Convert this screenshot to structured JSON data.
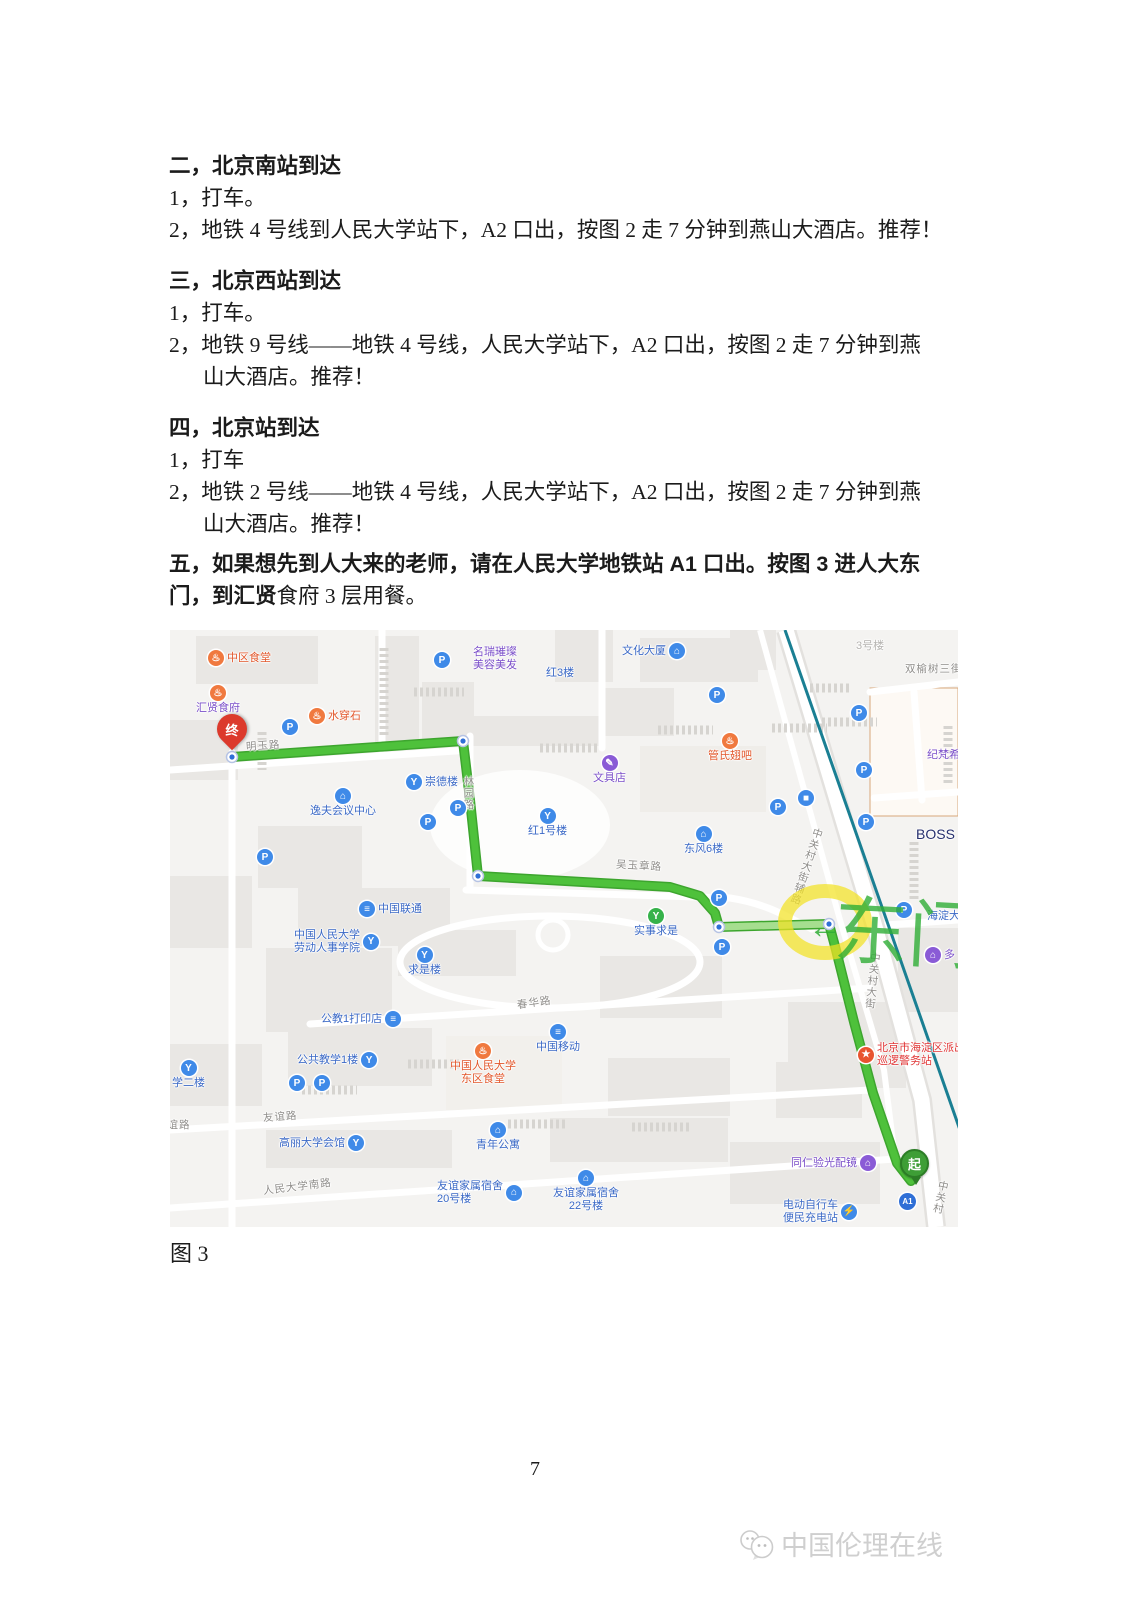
{
  "document": {
    "lines": [
      {
        "style": "h",
        "text": "二，北京南站到达"
      },
      {
        "style": "b",
        "text": "1，打车。"
      },
      {
        "style": "b",
        "text": "2，地铁 4 号线到人民大学站下，A2 口出，按图 2 走 7 分钟到燕山大酒店。推荐！"
      },
      {
        "style": "h",
        "text": "三，北京西站到达"
      },
      {
        "style": "b",
        "text": "1，打车。"
      },
      {
        "style": "b",
        "text": "2，地铁 9 号线——地铁 4 号线，人民大学站下，A2 口出，按图 2 走 7 分钟到燕"
      },
      {
        "style": "bi",
        "text": "山大酒店。推荐！"
      },
      {
        "style": "h",
        "text": "四，北京站到达"
      },
      {
        "style": "b",
        "text": "1，打车"
      },
      {
        "style": "b",
        "text": "2，地铁 2 号线——地铁 4 号线，人民大学站下，A2 口出，按图 2 走 7 分钟到燕"
      },
      {
        "style": "bi",
        "text": "山大酒店。推荐！"
      },
      {
        "style": "bold",
        "text": "五，如果想先到人大来的老师，请在人民大学地铁站 A1 口出。按图 3 进人大东"
      },
      {
        "style": "mixed",
        "bold": "门，到汇贤",
        "regular": "食府 3 层用餐。"
      }
    ]
  },
  "figure_caption": "图 3",
  "page_number": "7",
  "watermark": {
    "text": "中国伦理在线"
  },
  "map": {
    "palette": {
      "blue": "#3b69c6",
      "orange": "#e2572b",
      "purple": "#7b4fc9",
      "gray": "#8f8d8a",
      "red": "#e03636",
      "navy": "#27306e",
      "faded": "#b5b3b0"
    },
    "icon_defs": {
      "parking": {
        "g": "P",
        "bg": "#3f8ae8"
      },
      "food": {
        "g": "♨",
        "bg": "#f0793f"
      },
      "building": {
        "g": "⌂",
        "bg": "#3f8ae8"
      },
      "scenic": {
        "g": "Y",
        "bg": "#3f8ae8"
      },
      "telecom": {
        "g": "≡",
        "bg": "#3f8ae8"
      },
      "mobile": {
        "g": "≡",
        "bg": "#3f8ae8"
      },
      "bus": {
        "g": "■",
        "bg": "#3f8ae8"
      },
      "monument": {
        "g": "Y",
        "bg": "#36b24a"
      },
      "police": {
        "g": "★",
        "bg": "#e8542f"
      },
      "shop": {
        "g": "✎",
        "bg": "#8a5bd6"
      },
      "bag": {
        "g": "⌂",
        "bg": "#8a5bd6"
      },
      "charge": {
        "g": "⚡",
        "bg": "#3f8ae8"
      }
    },
    "route": {
      "points": "62,127 293,111 300,170 308,246 500,257 530,266 545,283 549,297 659,294 666,320 684,392 703,463 727,533 741,551",
      "light_points": "549,297 659,294",
      "color": "#4ec13b",
      "casing": "#3da52e",
      "light": "#a6de8f",
      "nodes": [
        [
          62,
          127
        ],
        [
          293,
          111
        ],
        [
          308,
          246
        ],
        [
          549,
          297
        ],
        [
          659,
          294
        ]
      ]
    },
    "subway": {
      "x1": 615,
      "y1": 0,
      "x2": 790,
      "y2": 500,
      "color": "#1a7f93"
    },
    "highlight": {
      "cx": 655,
      "cy": 292,
      "rx": 40,
      "ry": 31,
      "color": "#f3e224"
    },
    "annotation": {
      "text": "东门",
      "arrow": "←",
      "color": "#2fae36"
    },
    "markers": {
      "end_label": "终",
      "start_label": "起",
      "exit_label": "A1"
    },
    "pois": [
      {
        "name": "poi-zhongqu-canteen",
        "x": 38,
        "y": 20,
        "icon": "food",
        "pos": "left",
        "label": "中区食堂",
        "color": "orange"
      },
      {
        "name": "poi-mingrui-salon",
        "x": 303,
        "y": 16,
        "label": "名瑞璀璨\n美容美发",
        "color": "purple"
      },
      {
        "name": "poi-wenhua-plaza",
        "x": 452,
        "y": 13,
        "icon": "building",
        "pos": "right",
        "label": "文化大厦",
        "color": "blue"
      },
      {
        "name": "label-building-3",
        "x": 686,
        "y": 10,
        "label": "3号楼",
        "color": "faded"
      },
      {
        "name": "road-shuangyushu-3rd",
        "x": 735,
        "y": 33,
        "road": true,
        "label": "双榆树三街"
      },
      {
        "name": "label-hong-3",
        "x": 376,
        "y": 37,
        "label": "红3楼",
        "color": "blue"
      },
      {
        "name": "poi-huixian-canteen",
        "x": 26,
        "y": 55,
        "icon": "food",
        "pos": "above",
        "label": "汇贤食府",
        "color": "purple"
      },
      {
        "name": "poi-shuichuanshi",
        "x": 139,
        "y": 78,
        "icon": "food",
        "pos": "left",
        "label": "水穿石",
        "color": "orange"
      },
      {
        "name": "poi-guanshi-chiba",
        "x": 538,
        "y": 103,
        "icon": "food",
        "pos": "above",
        "label": "管氏翅吧",
        "color": "orange"
      },
      {
        "name": "poi-wenjudian",
        "x": 423,
        "y": 125,
        "icon": "shop",
        "pos": "above",
        "label": "文具店",
        "color": "purple"
      },
      {
        "name": "poi-chongdelou",
        "x": 236,
        "y": 144,
        "icon": "scenic",
        "pos": "left",
        "label": "崇德楼",
        "color": "blue"
      },
      {
        "name": "poi-yifu-center",
        "x": 140,
        "y": 158,
        "icon": "building",
        "pos": "above",
        "label": "逸夫会议中心",
        "color": "blue"
      },
      {
        "name": "poi-hong1-building",
        "x": 358,
        "y": 178,
        "icon": "scenic",
        "pos": "above",
        "label": "红1号楼",
        "color": "blue"
      },
      {
        "name": "poi-dongfeng6",
        "x": 514,
        "y": 196,
        "icon": "building",
        "pos": "above",
        "label": "东风6楼",
        "color": "blue"
      },
      {
        "name": "label-givenchy",
        "x": 757,
        "y": 119,
        "label": "纪梵希",
        "color": "purple"
      },
      {
        "name": "label-boss",
        "x": 746,
        "y": 196,
        "label": "BOSS",
        "color": "navy",
        "size": 14
      },
      {
        "name": "poi-shishiqiushi",
        "x": 464,
        "y": 278,
        "icon": "monument",
        "pos": "above",
        "label": "实事求是",
        "color": "blue"
      },
      {
        "name": "poi-china-unicom",
        "x": 189,
        "y": 271,
        "icon": "telecom",
        "pos": "left",
        "label": "中国联通",
        "color": "blue"
      },
      {
        "name": "poi-ruc-labor-school",
        "x": 124,
        "y": 299,
        "icon": "scenic",
        "pos": "right",
        "label": "中国人民大学\n劳动人事学院",
        "color": "blue"
      },
      {
        "name": "poi-qiushilou",
        "x": 238,
        "y": 317,
        "icon": "scenic",
        "pos": "above",
        "label": "求是楼",
        "color": "blue"
      },
      {
        "name": "poi-gongjiao1-print",
        "x": 151,
        "y": 381,
        "icon": "telecom",
        "pos": "right",
        "label": "公教1打印店",
        "color": "blue"
      },
      {
        "name": "road-chunhua",
        "x": 347,
        "y": 367,
        "road": true,
        "label": "春华路",
        "rotate": -8
      },
      {
        "name": "poi-public-teaching-1",
        "x": 127,
        "y": 422,
        "icon": "scenic",
        "pos": "right",
        "label": "公共教学1楼",
        "color": "blue"
      },
      {
        "name": "poi-teaching-2",
        "x": 2,
        "y": 430,
        "icon": "scenic",
        "pos": "above",
        "label": "学二楼",
        "color": "blue"
      },
      {
        "name": "poi-ruc-east-canteen",
        "x": 280,
        "y": 413,
        "icon": "food",
        "pos": "above",
        "label": "中国人民大学\n东区食堂",
        "color": "orange"
      },
      {
        "name": "poi-china-mobile",
        "x": 366,
        "y": 394,
        "icon": "mobile",
        "pos": "above",
        "label": "中国移动",
        "color": "blue"
      },
      {
        "name": "road-youyi",
        "x": 93,
        "y": 481,
        "road": true,
        "label": "友谊路",
        "rotate": -4
      },
      {
        "name": "road-youyi-2",
        "x": -14,
        "y": 489,
        "road": true,
        "label": "友谊路"
      },
      {
        "name": "poi-gaoli-hall",
        "x": 109,
        "y": 505,
        "icon": "scenic",
        "pos": "right",
        "label": "高丽大学会馆",
        "color": "blue"
      },
      {
        "name": "poi-youth-apartment",
        "x": 306,
        "y": 492,
        "icon": "building",
        "pos": "above",
        "label": "青年公寓",
        "color": "blue"
      },
      {
        "name": "road-renda-south",
        "x": 93,
        "y": 551,
        "road": true,
        "label": "人民大学南路",
        "rotate": -7
      },
      {
        "name": "poi-youyi-dorm-20",
        "x": 267,
        "y": 550,
        "icon": "building",
        "pos": "right",
        "label": "友谊家属宿舍\n20号楼",
        "color": "blue"
      },
      {
        "name": "poi-youyi-dorm-22",
        "x": 383,
        "y": 540,
        "icon": "building",
        "pos": "above",
        "label": "友谊家属宿舍\n22号楼",
        "color": "blue"
      },
      {
        "name": "poi-tongren-optical",
        "x": 621,
        "y": 525,
        "icon": "bag",
        "pos": "right",
        "label": "同仁验光配镜",
        "color": "purple"
      },
      {
        "name": "poi-ebike-charging",
        "x": 613,
        "y": 569,
        "icon": "charge",
        "pos": "right",
        "label": "电动自行车\n便民充电站",
        "color": "blue"
      },
      {
        "name": "poi-police-station",
        "x": 688,
        "y": 412,
        "icon": "police",
        "pos": "left",
        "label": "北京市海淀区派出\n巡逻警务站",
        "color": "red"
      },
      {
        "name": "label-haidian-st",
        "x": 757,
        "y": 280,
        "label": "海淀大",
        "color": "blue"
      },
      {
        "name": "poi-duo",
        "x": 755,
        "y": 317,
        "icon": "bag",
        "pos": "left",
        "label": "多",
        "color": "purple"
      },
      {
        "name": "road-zgc-side-road",
        "x": 630,
        "y": 196,
        "road": true,
        "vertical": true,
        "rotate": 18,
        "label": "中关村大街辅路"
      },
      {
        "name": "road-zgc-street",
        "x": 696,
        "y": 322,
        "road": true,
        "vertical": true,
        "rotate": 6,
        "label": "中关村大街"
      },
      {
        "name": "road-zgc-street-2",
        "x": 764,
        "y": 550,
        "road": true,
        "vertical": true,
        "rotate": 12,
        "label": "中关村"
      },
      {
        "name": "road-mingyu",
        "x": 76,
        "y": 110,
        "road": true,
        "rotate": -4,
        "label": "明玉路"
      },
      {
        "name": "road-linyuan",
        "x": 292,
        "y": 146,
        "road": true,
        "vertical": true,
        "label": "林园路"
      },
      {
        "name": "road-wuyuzhang",
        "x": 446,
        "y": 230,
        "road": true,
        "rotate": 3,
        "label": "吴玉章路"
      },
      {
        "name": "icon-parking-1",
        "x": 264,
        "y": 22,
        "icon": "parking"
      },
      {
        "name": "icon-parking-2",
        "x": 112,
        "y": 89,
        "icon": "parking"
      },
      {
        "name": "icon-parking-3",
        "x": 280,
        "y": 170,
        "icon": "parking"
      },
      {
        "name": "icon-parking-4",
        "x": 250,
        "y": 184,
        "icon": "parking"
      },
      {
        "name": "icon-parking-5",
        "x": 87,
        "y": 219,
        "icon": "parking"
      },
      {
        "name": "icon-parking-6",
        "x": 539,
        "y": 57,
        "icon": "parking"
      },
      {
        "name": "icon-parking-7",
        "x": 600,
        "y": 169,
        "icon": "parking"
      },
      {
        "name": "icon-parking-8",
        "x": 119,
        "y": 445,
        "icon": "parking"
      },
      {
        "name": "icon-parking-9",
        "x": 144,
        "y": 445,
        "icon": "parking"
      },
      {
        "name": "icon-parking-10",
        "x": 726,
        "y": 272,
        "icon": "parking"
      },
      {
        "name": "icon-parking-11",
        "x": 681,
        "y": 75,
        "icon": "parking"
      },
      {
        "name": "icon-parking-12",
        "x": 686,
        "y": 132,
        "icon": "parking"
      },
      {
        "name": "icon-parking-13",
        "x": 688,
        "y": 184,
        "icon": "parking"
      },
      {
        "name": "icon-parking-14",
        "x": 541,
        "y": 260,
        "icon": "parking"
      },
      {
        "name": "icon-parking-15",
        "x": 544,
        "y": 309,
        "icon": "parking"
      },
      {
        "name": "icon-bus-stop",
        "x": 628,
        "y": 160,
        "icon": "bus"
      }
    ]
  }
}
